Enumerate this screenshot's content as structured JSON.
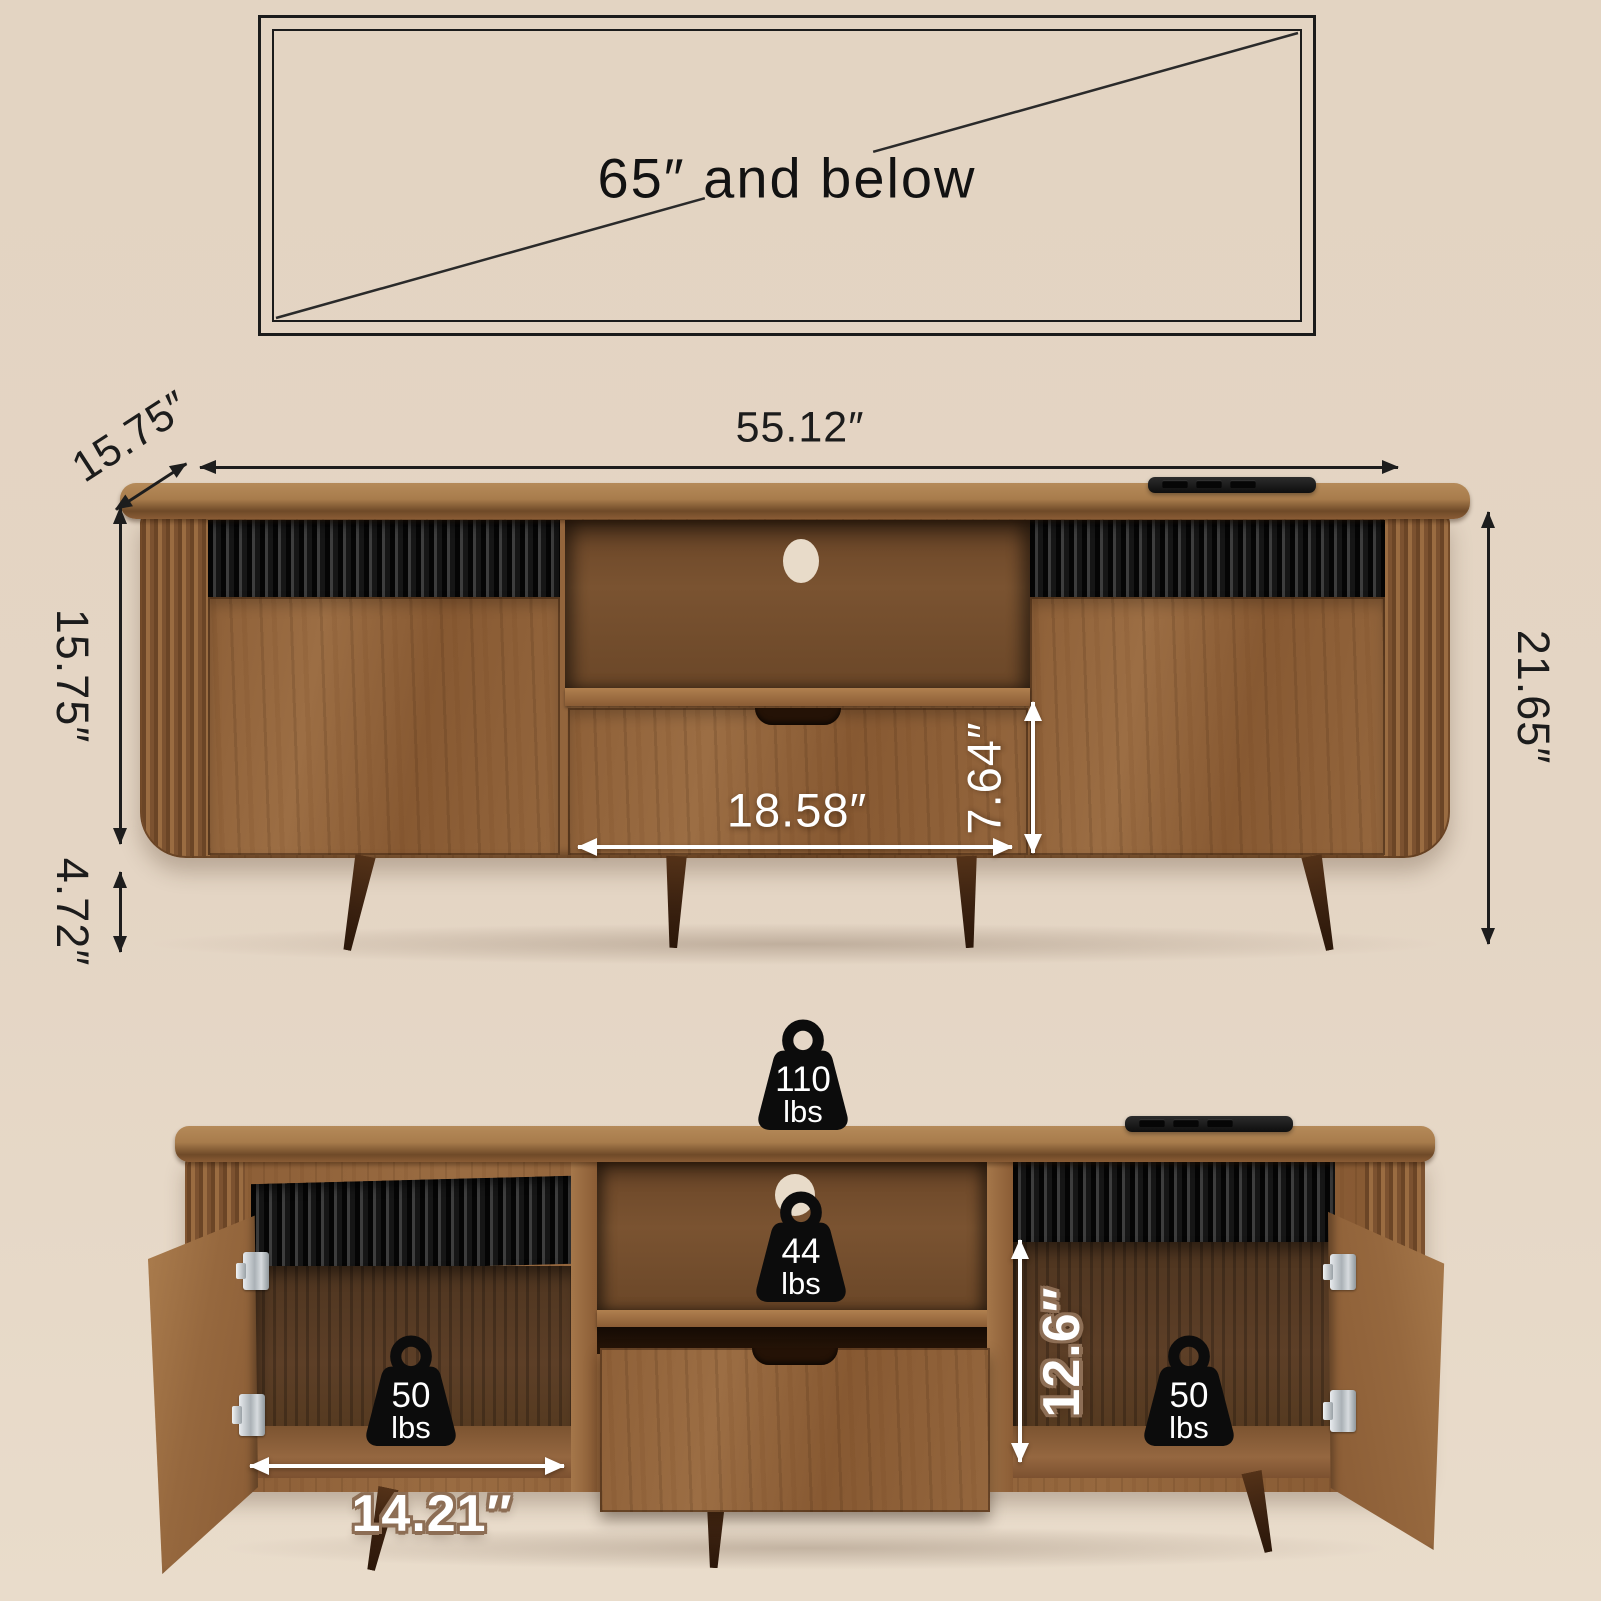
{
  "meta": {
    "description": "TV stand dimension and weight-capacity diagram",
    "colors": {
      "background": "#e4d5c3",
      "line_black": "#1d1d1d",
      "label_white": "#ffffff",
      "label_outline_tan": "#8d6e55",
      "wood_mid": "#8f6239",
      "wood_dark_interior": "#54391f",
      "fluted_black_panel": "#161616",
      "leg_brown": "#3a2110"
    }
  },
  "tv_box": {
    "label": "65″ and below"
  },
  "closed_view": {
    "width": "55.12″",
    "depth": "15.75″",
    "body_height": "15.75″",
    "leg_height": "4.72″",
    "total_height": "21.65″",
    "drawer_width": "18.58″",
    "drawer_height": "7.64″"
  },
  "open_view": {
    "top_capacity": {
      "value": "110",
      "unit": "lbs"
    },
    "shelf_capacity": {
      "value": "44",
      "unit": "lbs"
    },
    "left_cabinet_capacity": {
      "value": "50",
      "unit": "lbs"
    },
    "right_cabinet_capacity": {
      "value": "50",
      "unit": "lbs"
    },
    "cabinet_inner_width": "14.21″",
    "cabinet_inner_height": "12.6″"
  }
}
